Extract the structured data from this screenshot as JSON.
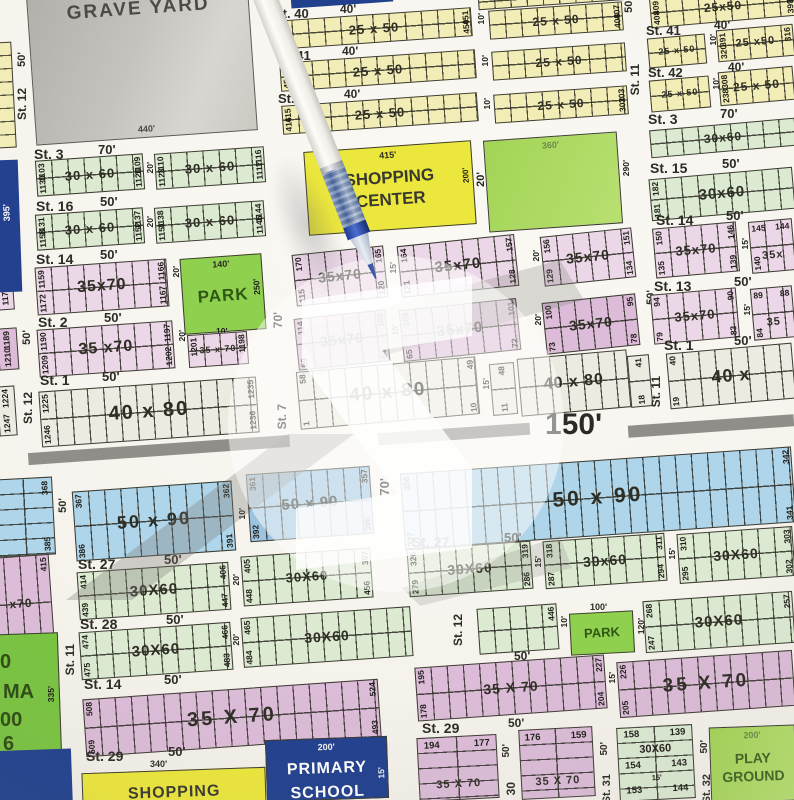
{
  "amenities": {
    "grave_yard": {
      "name": "GRAVE YARD",
      "dim": "440'"
    },
    "shopping_center": {
      "l1": "SHOPPING",
      "l2": "CENTER",
      "top": "415'",
      "side": "200'"
    },
    "play_ground_1": {
      "name": "PLAY GROUND",
      "top": "360'",
      "side": "290'"
    },
    "park_1": {
      "name": "PARK",
      "top": "140'",
      "side": "250'"
    },
    "park_2": {
      "name": "PARK",
      "top": "100'",
      "side": "120'",
      "gap": "10'"
    },
    "play_ground_2": {
      "l1": "PLAY",
      "l2": "GROUND",
      "top": "200'"
    },
    "shopping_2": {
      "name": "SHOPPING",
      "top": "340'"
    },
    "primary_school": {
      "l1": "PRIMARY",
      "l2": "SCHOOL",
      "top": "200'",
      "side": "15'"
    },
    "cinema": {
      "f1": "0",
      "f2": "MA",
      "f3": "00",
      "f4": "6",
      "side": "335'"
    }
  },
  "roads": {
    "main": "150'",
    "left": "395'"
  },
  "gaps": {
    "g10": "10'",
    "g15": "15'",
    "g20": "20'"
  },
  "streets": {
    "st12_top": {
      "n": "St. 12",
      "w": "50'"
    },
    "st40": {
      "n": "St. 40",
      "w": "40'"
    },
    "st41": {
      "n": "St. 41",
      "w": "40'"
    },
    "st42": {
      "n": "St. 42",
      "w": "40'"
    },
    "st11_top": {
      "n": "St. 11",
      "w": "50'"
    },
    "st41r": {
      "n": "St. 41",
      "w": "40'"
    },
    "st42r": {
      "n": "St. 42",
      "w": "40'"
    },
    "st3r": {
      "n": "St. 3",
      "w": "70'"
    },
    "st3": {
      "n": "St. 3",
      "w": "70'"
    },
    "st16": {
      "n": "St. 16",
      "w": "50'"
    },
    "st14": {
      "n": "St. 14",
      "w": "50'"
    },
    "st2": {
      "n": "St. 2",
      "w": "50'"
    },
    "st1": {
      "n": "St. 1",
      "w": "50'"
    },
    "st12_mid": "St. 12",
    "st7": "St. 7",
    "st15r": {
      "n": "St. 15",
      "w": "50'"
    },
    "st14r": {
      "n": "St. 14",
      "w": "50'"
    },
    "st13r": {
      "n": "St. 13",
      "w": "50'"
    },
    "st1r": {
      "n": "St. 1",
      "w": "50'"
    },
    "st11r": "St. 11",
    "park70": "70'",
    "mid50": "50'",
    "lc50": "50'",
    "blue50": "50'",
    "blue70": "70'",
    "st27": {
      "n": "St. 27",
      "w": "50'"
    },
    "st27r": {
      "n": "St. 27",
      "w": "50'"
    },
    "st28": {
      "n": "St. 28",
      "w": "50'"
    },
    "st11b": "St. 11",
    "st12b": "St. 12",
    "st14b": {
      "n": "St. 14",
      "w": "50'"
    },
    "r14bw": "50'",
    "st29": {
      "n": "St. 29",
      "w": "50'"
    },
    "st29r": {
      "n": "St. 29",
      "w": "50'"
    },
    "st30": "30",
    "st31": "St. 31",
    "st32": "St. 32",
    "w50a": "50'",
    "w50b": "50'",
    "w50c": "50'"
  },
  "rows": {
    "r40b1": {
      "size": "25 x 50",
      "lt": "495",
      "lb": "496",
      "rt": "451",
      "rb": "450"
    },
    "r40b2": {
      "size": "25 x 50",
      "rt": "407",
      "rb": "408"
    },
    "r41b1": {
      "size": "25 x 50",
      "lt": "455",
      "lb": "456"
    },
    "r41b2": {
      "size": "25 x 50"
    },
    "r42b1": {
      "size": "25 x 50",
      "lt": "415",
      "lb": "416"
    },
    "r42b2": {
      "size": "25 x 50",
      "rt": "303",
      "rb": "302"
    },
    "rr40": {
      "size": "25x50",
      "lt": "409",
      "lb": "408",
      "rt": "398",
      "rb": "399"
    },
    "rr41b1": {
      "size": "25 x 50"
    },
    "rr41b2": {
      "size": "25 x50",
      "lt": "391",
      "lb": "320",
      "rt": "316"
    },
    "rr42b1": {
      "size": "25 x 50"
    },
    "rr42b2": {
      "size": "25 x 50",
      "lt": "308",
      "lb": "238"
    },
    "rr3": {
      "size": "30x60"
    },
    "r3b1": {
      "size": "30 x 60",
      "lt": "1103",
      "lb": "1130",
      "rt": "1109",
      "rb": "1124"
    },
    "r3b2": {
      "size": "30 x 60",
      "lt": "1110",
      "lb": "1123",
      "rt": "1116",
      "rb": "1117"
    },
    "r16b1": {
      "size": "30 x 60",
      "lt": "1131",
      "lb": "1158",
      "rt": "1137",
      "rb": "1152"
    },
    "r16b2": {
      "size": "30 x 60",
      "lt": "1138",
      "lb": "1151",
      "rt": "1144",
      "rb": "1145"
    },
    "r14": {
      "size": "35x70",
      "lt": "1159",
      "lb": "1172",
      "rt": "1166",
      "rb": "1167"
    },
    "r2b1": {
      "size": "35 x70",
      "lt": "1190",
      "lb": "1209",
      "rt": "1197",
      "rb": "1202"
    },
    "r2b2": {
      "size": "35 x 70",
      "lt": "1201",
      "rt": "1198"
    },
    "lc": {
      "a": "1173",
      "bt": "1189",
      "bb": "1210",
      "ct": "1224",
      "cb": "1247"
    },
    "r1L": {
      "size": "40 x 80",
      "lt": "1225",
      "lb": "1246",
      "rt": "1235",
      "rb": "1236"
    },
    "rc1a": {
      "size": "35x70",
      "lt": "170",
      "lb": "115",
      "rt": "165",
      "rb": "120"
    },
    "rc1b": {
      "size": "35x70",
      "lt": "164",
      "lb": "121",
      "rt": "157",
      "rb": "128"
    },
    "rc1c": {
      "size": "35x70",
      "lt": "156",
      "lb": "129",
      "rt": "151",
      "rb": "134"
    },
    "rc2a": {
      "size": "35x70",
      "lt": "114",
      "lb": "59",
      "rt": "109",
      "rb": "64"
    },
    "rc2b": {
      "size": "35x70",
      "lt": "108",
      "lb": "65",
      "rt": "101",
      "rb": "72"
    },
    "rc2c": {
      "size": "35x70",
      "lt": "100",
      "lb": "73",
      "rt": "95",
      "rb": "78"
    },
    "rr15": {
      "size": "30x60",
      "lt": "182",
      "lb": "181"
    },
    "rr14b1": {
      "size": "35x70",
      "lt": "150",
      "lb": "135",
      "rt": "146",
      "rb": "139"
    },
    "rr14b2": {
      "size": "35x",
      "tl": "145",
      "tr": "144",
      "bl": "140"
    },
    "rr13b1": {
      "size": "35x70",
      "lt": "94",
      "lb": "79",
      "rt": "90",
      "rb": "83"
    },
    "rr13b2": {
      "size": "35",
      "tl": "89",
      "tr": "88",
      "bl": "84"
    },
    "rc3a": {
      "size": "40 x 80",
      "lt": "58",
      "lb": "1",
      "rt": "49",
      "rb": "10"
    },
    "rc3k": {
      "t": "48",
      "b": "11"
    },
    "rc3b": {
      "size": "40 x 80"
    },
    "rc3k2": {
      "t": "41",
      "b": "18"
    },
    "rr1": {
      "size": "40 x",
      "lt": "40",
      "lb": "19"
    },
    "blus": {
      "t": "368",
      "b": "385"
    },
    "blu1": {
      "size": "50 x 90",
      "lt": "367",
      "lb": "386",
      "rt": "362",
      "rb": "391"
    },
    "blu2": {
      "size": "50 x 90",
      "lt": "361",
      "lb": "392",
      "rt": "357",
      "rb": "396"
    },
    "blu3": {
      "size": "50 x 90",
      "lt": "356",
      "lb": "327",
      "rt": "342",
      "rb": "341"
    },
    "r27b1": {
      "size": "30X60",
      "lt": "414",
      "lb": "439",
      "rt": "406",
      "rb": "447"
    },
    "r27b2": {
      "size": "30X60",
      "lt": "405",
      "lb": "448",
      "rt": "397",
      "rb": "456"
    },
    "r27rb1": {
      "size": "30X60",
      "lt": "326",
      "lb": "279",
      "rt": "319",
      "rb": "286"
    },
    "r27rb2": {
      "size": "30x60",
      "lt": "318",
      "lb": "287",
      "rt": "311",
      "rb": "294"
    },
    "r27rb3": {
      "size": "30X60",
      "lt": "310",
      "lb": "295",
      "rt": "303",
      "rb": "302"
    },
    "r28b1": {
      "size": "30X60",
      "lt": "474",
      "lb": "475",
      "rt": "466",
      "rb": "483"
    },
    "r28b2": {
      "size": "30X60",
      "lt": "465",
      "lb": "484"
    },
    "r28b3": {
      "rt": "446"
    },
    "r28r": {
      "size": "30X60",
      "lt": "268",
      "lb": "247",
      "rt": "257"
    },
    "r14bb1": {
      "size": "35 X 70",
      "lt": "508",
      "lb": "509",
      "rt": "524",
      "rb": "493"
    },
    "r14bb2": {
      "size": "35 X 70",
      "lt": "195",
      "lb": "178",
      "rt": "227",
      "rb": "204"
    },
    "r14bb3": {
      "size": "35 X 70",
      "lt": "226",
      "lb": "205"
    },
    "p194": {
      "a": "194",
      "b": "177",
      "size": "35 X 70"
    },
    "p176": {
      "a": "176",
      "b": "159",
      "size": "35 X 70"
    },
    "g158": {
      "a1": "158",
      "b1": "139",
      "size": "30X60",
      "a2": "154",
      "b2": "143",
      "g": "15'",
      "a3": "153",
      "b3": "144"
    },
    "pe": {
      "t": "415",
      "b": "438",
      "size": "x70"
    }
  }
}
